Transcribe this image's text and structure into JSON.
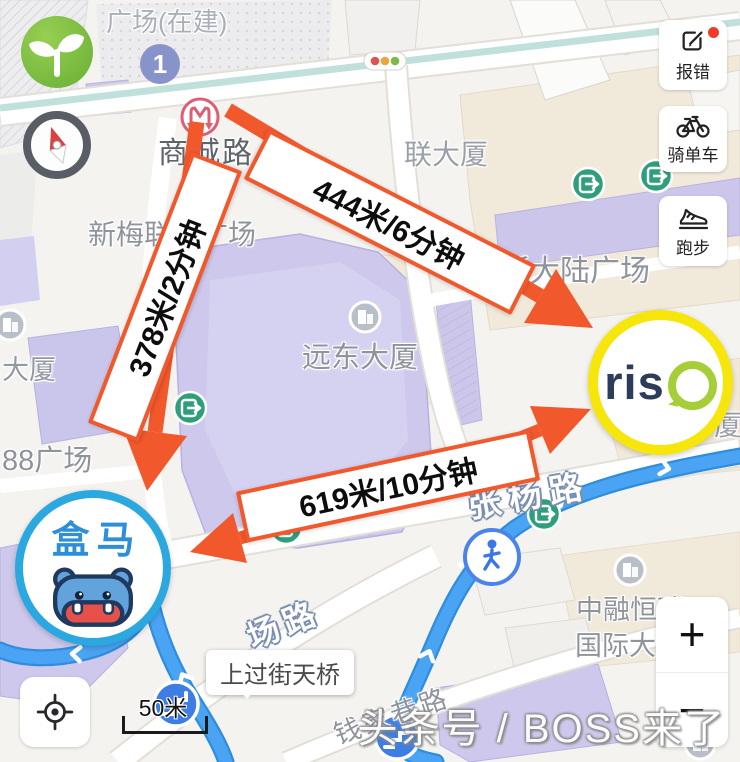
{
  "colors": {
    "accent_orange": "#F1582C",
    "route_blue": "#4AA4F3",
    "hema_blue": "#2BA8E0",
    "hema_text": "#2E8FD9",
    "riso_yellow": "#F6E60C",
    "riso_green": "#A6CE39",
    "riso_navy": "#2C3C5C",
    "metro_red": "#DD5F74",
    "exit_green": "#2F9E7B"
  },
  "map_labels": {
    "plaza_under_construction": "广场(在建)",
    "metro_station": "商城路",
    "xinmei_plaza": "新梅联合广场",
    "yuandong_tower": "远东大厦",
    "plaza_88": "88广场",
    "tower_left": "大厦",
    "lian_tower": "联大厦",
    "new_continent_plaza": "新大陆广场",
    "zhangyang_road": "张杨路",
    "road_fragment": "场路",
    "qianjia_lane": "钱家巷路",
    "zhongrong_line1": "中融恒瑞",
    "zhongrong_line2": "国际大",
    "xia_fragment": "厦",
    "line1_badge": "1"
  },
  "route_annotations": {
    "walk_a": "378米/2分钟",
    "walk_b": "444米/6分钟",
    "walk_c": "619米/10分钟"
  },
  "markers": {
    "hema_label": "盒马",
    "riso_label": "ris"
  },
  "tooltip": {
    "footbridge": "上过街天桥"
  },
  "controls": {
    "report_error": "报错",
    "cycling": "骑单车",
    "running": "跑步",
    "zoom_in": "+",
    "zoom_out": "−",
    "scale": "50米"
  },
  "watermark": "头条号 / BOSS来了"
}
